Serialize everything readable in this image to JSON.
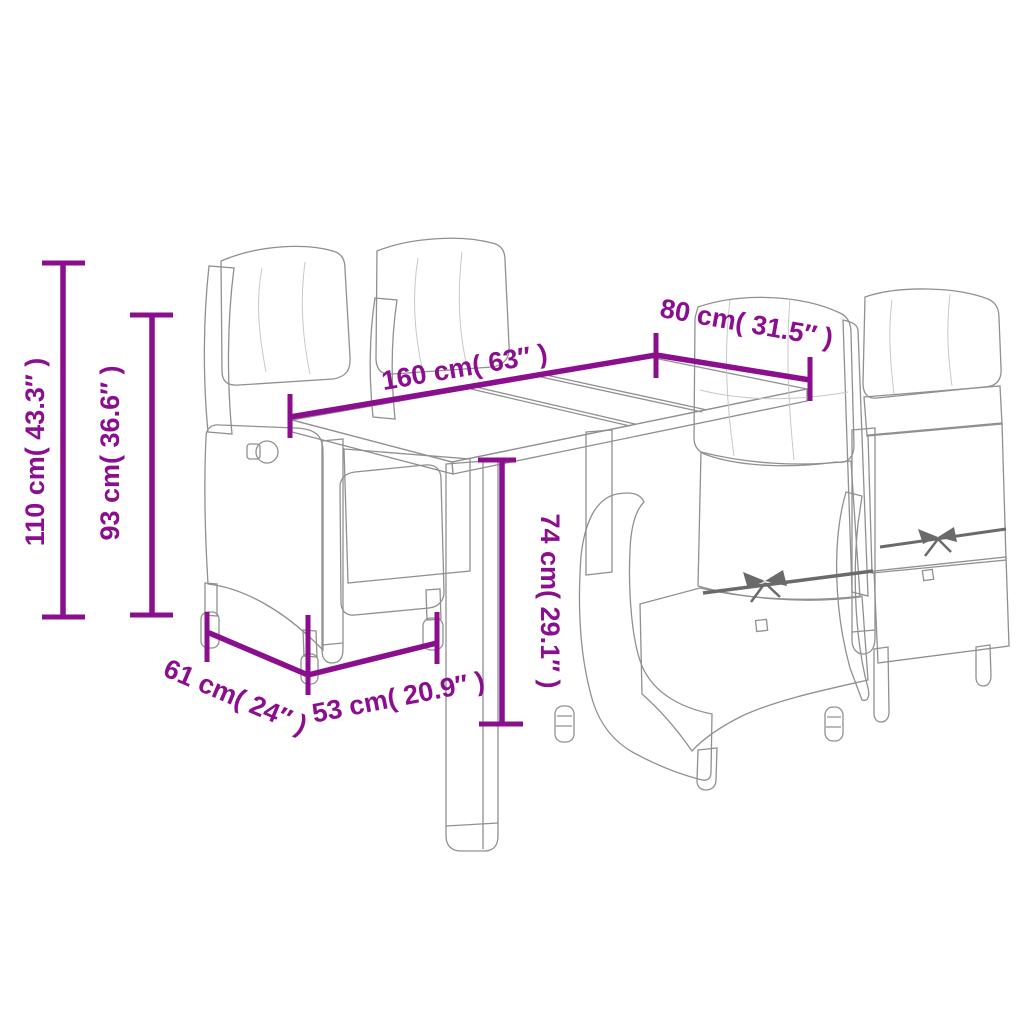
{
  "page": {
    "background": "#ffffff",
    "kind": "product-dimension-diagram"
  },
  "colors": {
    "dimension_accent": "#8B0E8E",
    "line_art_stroke": "#909090",
    "rattan_texture": "#b4b4b4",
    "cushion_fill": "#ffffff",
    "strap_dark": "#6a6a6a"
  },
  "scene": {
    "objects": [
      {
        "name": "garden-dining-table"
      },
      {
        "name": "reclining-chair-back-left"
      },
      {
        "name": "reclining-chair-back-center"
      },
      {
        "name": "reclining-chair-front-right"
      },
      {
        "name": "reclining-chair-far-right"
      }
    ]
  },
  "dimensions": [
    {
      "id": "total-height",
      "label": "110 cm( 43.3″ )",
      "cm": 110,
      "inches": 43.3,
      "orientation": "vertical"
    },
    {
      "id": "backrest-height",
      "label": "93 cm( 36.6″ )",
      "cm": 93,
      "inches": 36.6,
      "orientation": "vertical"
    },
    {
      "id": "table-length",
      "label": "160 cm( 63″ )",
      "cm": 160,
      "inches": 63,
      "orientation": "diagonal"
    },
    {
      "id": "table-depth",
      "label": "80 cm( 31.5″ )",
      "cm": 80,
      "inches": 31.5,
      "orientation": "diagonal"
    },
    {
      "id": "table-height",
      "label": "74 cm( 29.1″ )",
      "cm": 74,
      "inches": 29.1,
      "orientation": "vertical"
    },
    {
      "id": "chair-depth",
      "label": "61 cm( 24″ )",
      "cm": 61,
      "inches": 24,
      "orientation": "diagonal"
    },
    {
      "id": "chair-width",
      "label": "53 cm( 20.9″ )",
      "cm": 53,
      "inches": 20.9,
      "orientation": "diagonal"
    }
  ]
}
